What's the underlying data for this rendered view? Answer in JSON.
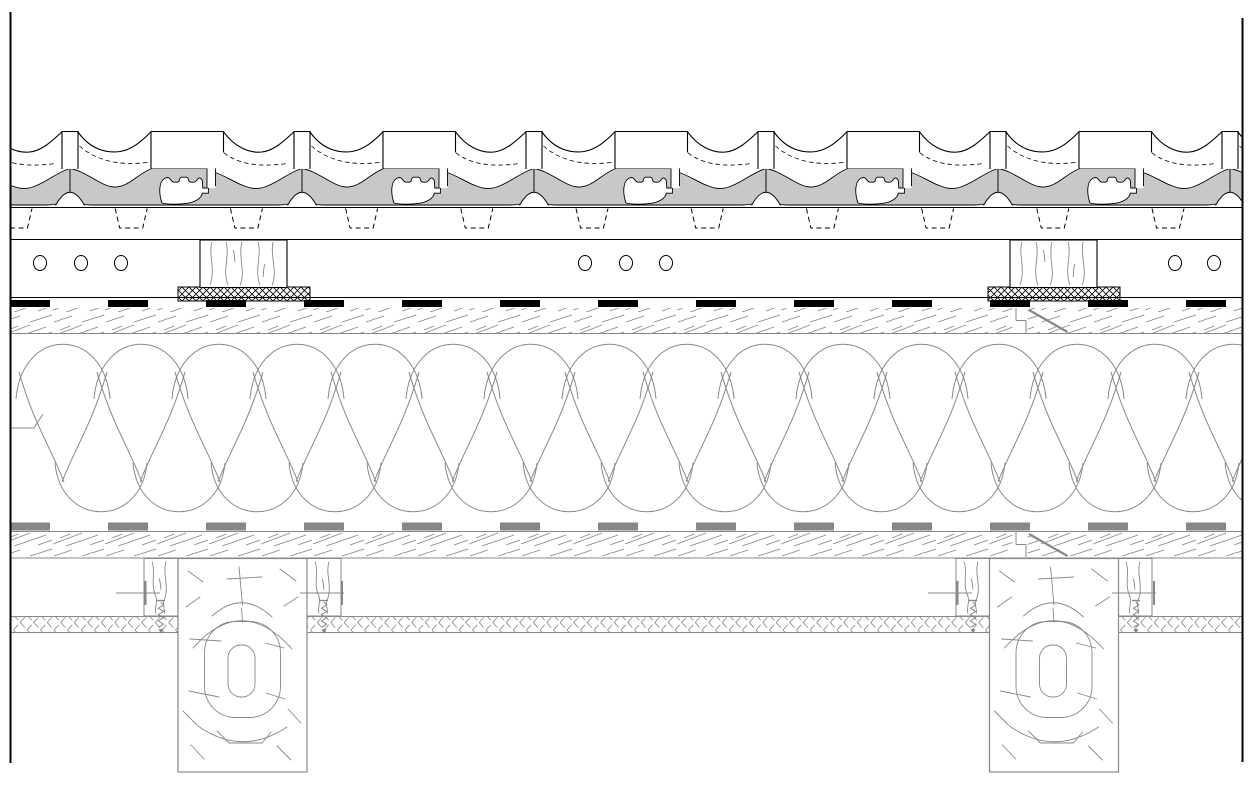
{
  "drawing": {
    "type": "roof-construction-cross-section",
    "canvas": {
      "width": 1258,
      "height": 794,
      "background": "#ffffff"
    },
    "colors": {
      "ink": "#000000",
      "gray": "#878787",
      "tile_fill": "#c8c8c8",
      "white": "#ffffff"
    },
    "border": {
      "left_x": 10.5,
      "right_x": 1242.5,
      "top_y": 12,
      "bottom_y": 763,
      "stroke_width": 2
    },
    "guide_lines_y": [
      207.5,
      239.5,
      297.5
    ],
    "tiles": {
      "clip": [
        10,
        118,
        1233,
        114
      ],
      "period": 232,
      "start_x": 62,
      "first_index": -1,
      "count": 7,
      "nibs": {
        "start_x": 16,
        "spacing": 115.2,
        "count": 11,
        "top_y": 208.5,
        "bottom_y": 228,
        "half_top": 16,
        "half_bottom": 11.5
      }
    },
    "vent_holes": {
      "cy": 263,
      "rx": 6.5,
      "ry": 7.5,
      "cx_list": [
        40,
        81,
        121,
        585,
        626,
        666,
        1175,
        1214
      ]
    },
    "top_battens": {
      "y": 240,
      "height": 47.5,
      "width": 87,
      "x_list": [
        200,
        1010
      ]
    },
    "nail_pads": {
      "y": 287,
      "height": 14,
      "width": 132,
      "x_list": [
        178,
        988
      ]
    },
    "sarking_membrane": {
      "y": 303.5,
      "thickness": 7,
      "dash": [
        40,
        58
      ]
    },
    "board_layers": [
      {
        "y": 308,
        "height": 25,
        "top_line_y": null,
        "bottom_line_y": 333.5
      },
      {
        "y": 532,
        "height": 26,
        "top_line_y": 531.5,
        "bottom_line_y": 558
      }
    ],
    "board_joints": [
      {
        "x": 1012.5,
        "w": 15,
        "y1": 308,
        "y2": 333
      },
      {
        "x": 1012.5,
        "w": 15,
        "y1": 532,
        "y2": 557
      }
    ],
    "insulation": {
      "clip": [
        11,
        336,
        1231,
        183
      ],
      "period": 78,
      "first_index": -1,
      "count": 17,
      "cut_mark": [
        [
          11,
          428
        ],
        [
          34,
          428
        ],
        [
          43,
          414
        ]
      ]
    },
    "vapour_membrane": {
      "y": 526.5,
      "thickness": 8,
      "dash": [
        40,
        58
      ]
    },
    "ceiling_board": {
      "y": 617,
      "height": 15,
      "segments": [
        [
          10,
          178
        ],
        [
          307,
          990
        ],
        [
          1118,
          1243
        ]
      ]
    },
    "service_battens": {
      "y": 558.5,
      "height": 57.5,
      "width": 34,
      "x_list": [
        144,
        307,
        956,
        1118
      ]
    },
    "beams": {
      "y": 558.5,
      "bottom_y": 772,
      "width": 129,
      "x_list": [
        178,
        989.5
      ],
      "ring_offset": 811.5
    },
    "brackets": {
      "line_y": 593,
      "v_top": 581,
      "v_bottom": 605,
      "items": [
        {
          "h": [
            116,
            160
          ],
          "v_x": 145.5
        },
        {
          "h": [
            300,
            344
          ],
          "v_x": 342
        },
        {
          "h": [
            928,
            972
          ],
          "v_x": 957.5
        },
        {
          "h": [
            1112,
            1156
          ],
          "v_x": 1154
        }
      ]
    },
    "screws": {
      "cx_list": [
        161,
        324,
        973,
        1136
      ],
      "bar_y": 600.5,
      "zig_top": 602,
      "zig_bottom": 629,
      "tip_y": 634,
      "amp": 2.6
    }
  }
}
